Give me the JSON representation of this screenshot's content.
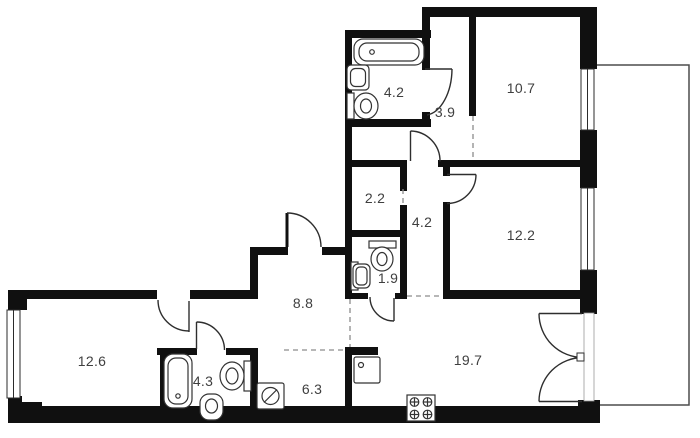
{
  "plan": {
    "type": "apartment-floor-plan",
    "colors": {
      "wall": "#101010",
      "fixture_line": "#333333",
      "dashed_boundary": "#8c8c8c",
      "label": "#3f3f3f",
      "balcony_line": "#4d4d4d",
      "background": "#ffffff"
    },
    "rooms": [
      {
        "name": "bathroom-top",
        "area_label": "4.2"
      },
      {
        "name": "entry-hall",
        "area_label": "3.9"
      },
      {
        "name": "bedroom-top-right",
        "area_label": "10.7"
      },
      {
        "name": "wardrobe",
        "area_label": "2.2"
      },
      {
        "name": "corridor",
        "area_label": "4.2"
      },
      {
        "name": "bedroom-right",
        "area_label": "12.2"
      },
      {
        "name": "wc",
        "area_label": "1.9"
      },
      {
        "name": "hallway",
        "area_label": "8.8"
      },
      {
        "name": "room-left",
        "area_label": "12.6"
      },
      {
        "name": "bathroom-left",
        "area_label": "4.3"
      },
      {
        "name": "utility-room",
        "area_label": "6.3"
      },
      {
        "name": "kitchen-living",
        "area_label": "19.7"
      }
    ],
    "fixtures": [
      "bathtub",
      "sink",
      "toilet",
      "washing-machine",
      "kitchen-sink",
      "stove",
      "window",
      "balcony",
      "door-swing"
    ]
  }
}
